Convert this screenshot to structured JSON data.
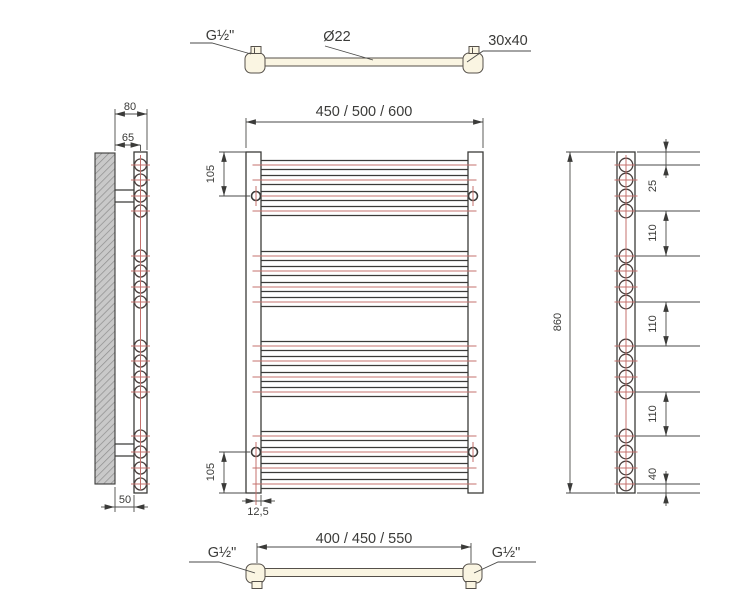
{
  "drawing_title": "heated-towel-rail-technical-drawing",
  "labels": {
    "top_view": {
      "left": "G½\"",
      "center": "Ø22",
      "right": "30x40"
    },
    "front_view": {
      "width": "450 / 500 / 600",
      "top_hole": "105",
      "bottom_hole": "105",
      "hole_inset": "12,5"
    },
    "left_view": {
      "outer": "80",
      "center": "65",
      "inner": "50"
    },
    "right_view": {
      "total": "860",
      "top": "25",
      "gap1": "110",
      "gap2": "110",
      "gap3": "110",
      "bottom": "40"
    },
    "bottom_view": {
      "width": "400 / 450 / 550",
      "left": "G½\"",
      "right": "G½\""
    }
  },
  "colors": {
    "line": "#3b3b39",
    "dimension": "#4a4a48",
    "centerline_red": "#c4706c",
    "tube_fill": "#faf5e2",
    "wall_fill": "#c9c9c9",
    "wall_hatch": "#8d8d8d"
  },
  "geometry": {
    "tube_centers_y": [
      165,
      180,
      196,
      211,
      256,
      271,
      287,
      302,
      346,
      361,
      377,
      392,
      436,
      452,
      468,
      484
    ],
    "front": {
      "tube_x1": 261,
      "tube_x2": 468,
      "red_x1": 252.5,
      "red_x2": 476.5,
      "half_h": 4.5
    },
    "left_view": {
      "cx": 140.5,
      "r": 6.0,
      "tick_x1": 131,
      "tick_x2": 150
    },
    "right_view": {
      "cx": 626,
      "r": 6.8,
      "tick_x1": 614.5,
      "tick_x2": 637.5,
      "ext_indices": [
        0,
        3,
        4,
        7,
        8,
        11,
        12,
        15
      ],
      "ext_x1": 635,
      "ext_x2": 700
    }
  }
}
